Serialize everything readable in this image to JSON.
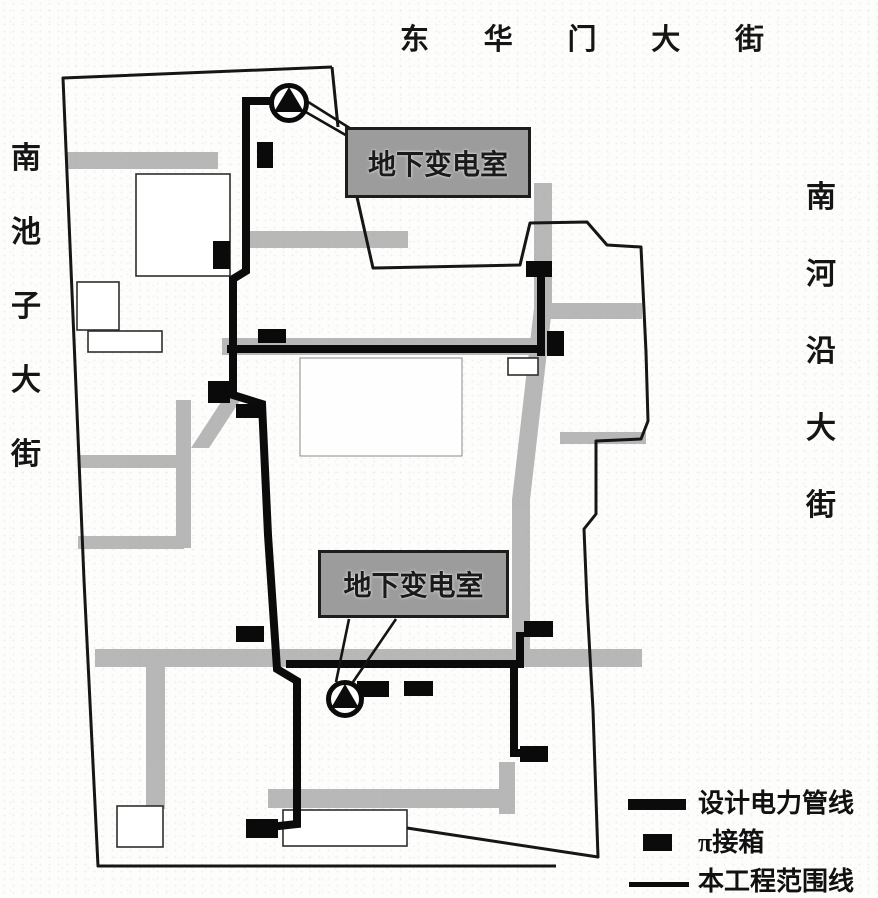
{
  "figure": {
    "kind": "scanned site plan – electric power pipeline layout",
    "substation_count": 2,
    "junction_box_count": 13
  },
  "streets": {
    "top": {
      "name": "东华门大街",
      "chars": [
        "东",
        "华",
        "门",
        "大",
        "街"
      ]
    },
    "left": {
      "name": "南池子大街",
      "chars": [
        "南",
        "池",
        "子",
        "大",
        "街"
      ]
    },
    "right": {
      "name": "南河沿大街",
      "chars": [
        "南",
        "河",
        "沿",
        "大",
        "街"
      ]
    }
  },
  "annotations": {
    "substation_top": "地下变电室",
    "substation_bottom": "地下变电室"
  },
  "legend": {
    "items": [
      {
        "symbol": "thick-line",
        "label": "设计电力管线"
      },
      {
        "symbol": "junction-box",
        "label": "π接箱"
      },
      {
        "symbol": "thin-line",
        "label": "本工程范围线"
      }
    ]
  },
  "colors": {
    "power_line": "#0b0b0b",
    "boundary_line": "#161616",
    "street_gray": "#a8a8a8",
    "callout_gray": "#9c9c9c",
    "paper": "#fdfdfc"
  }
}
